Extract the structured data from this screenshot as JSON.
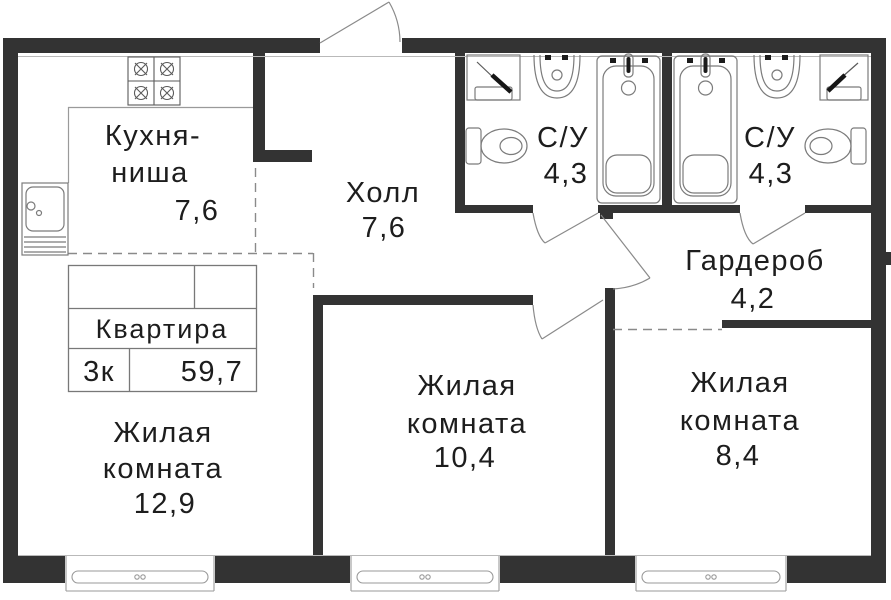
{
  "colors": {
    "wall": "#333333",
    "fixture_line": "#7b7b7b",
    "text": "#1d1d1d"
  },
  "legend": {
    "title": "Квартира",
    "rooms_count": "3к",
    "total_area": "59,7"
  },
  "rooms": {
    "kitchen": {
      "name_line1": "Кухня-",
      "name_line2": "ниша",
      "area": "7,6"
    },
    "hall": {
      "name": "Холл",
      "area": "7,6"
    },
    "bathroom1": {
      "name": "С/У",
      "area": "4,3"
    },
    "bathroom2": {
      "name": "С/У",
      "area": "4,3"
    },
    "wardrobe": {
      "name": "Гардероб",
      "area": "4,2"
    },
    "living1": {
      "name_line1": "Жилая",
      "name_line2": "комната",
      "area": "12,9"
    },
    "living2": {
      "name_line1": "Жилая",
      "name_line2": "комната",
      "area": "10,4"
    },
    "living3": {
      "name_line1": "Жилая",
      "name_line2": "комната",
      "area": "8,4"
    }
  },
  "icons": {
    "stove": "stove-icon",
    "kitchen_sink": "kitchen-sink-icon",
    "washing_machine": "washing-machine-icon",
    "bathroom_sink": "bathroom-sink-icon",
    "bathtub": "bathtub-icon",
    "toilet": "toilet-icon",
    "window": "window-icon",
    "door": "door-swing-icon"
  }
}
